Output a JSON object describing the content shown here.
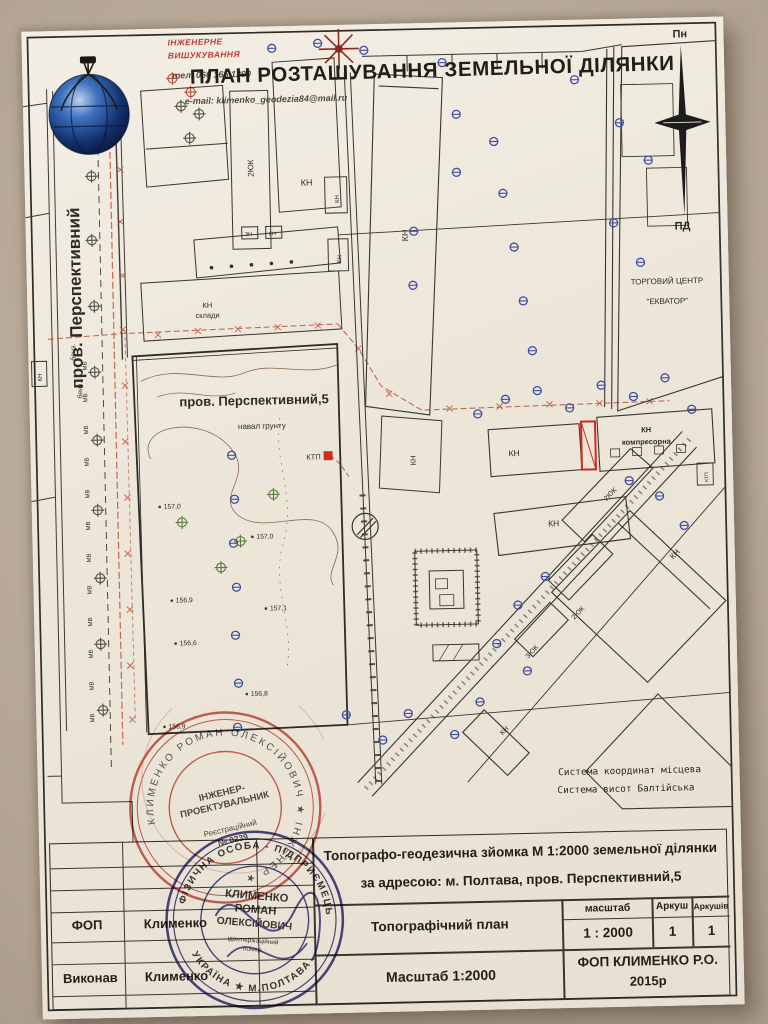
{
  "header": {
    "company_line1": "ІНЖЕНЕРНЕ",
    "company_line2": "ВИШУКУВАННЯ",
    "phone": "тел. 066 165 1200",
    "email": "e-mail: klimenko_geodezia84@mail.ru",
    "title": "ПЛАН РОЗТАШУВАННЯ ЗЕМЕЛЬНОЇ ДІЛЯНКИ"
  },
  "compass": {
    "north": "Пн",
    "south": "ПД"
  },
  "map": {
    "street_name": "пров. Перспективний",
    "parcel_label": "пров. Перспективний,5",
    "soil_note": "навал грунту",
    "ktp": "КТП",
    "kn": "КН",
    "kn_sklady_line1": "КН",
    "kn_sklady_line2": "склади",
    "kompresorna_line1": "КН",
    "kompresorna_line2": "компресорна",
    "label_2yuk": "2ЮК",
    "label_3yuk": "ЗЮК",
    "label_zn": "ЗН",
    "mall_line1": "ТОРГОВИЙ ЦЕНТР",
    "mall_line2": "\"ЕКВАТОР\"",
    "mv": "МВ",
    "benz": "бенз.",
    "elevations": [
      "157,0",
      "157,0",
      "156,9",
      "157,1",
      "156,6",
      "156,8",
      "156,9"
    ],
    "coord_line1": "Система координат місцева",
    "coord_line2": "Система висот Балтійська"
  },
  "title_block": {
    "survey_line1": "Топографо-геодезична зйомка М 1:2000 земельної ділянки",
    "survey_line2": "за адресою: м. Полтава, пров. Перспективний,5",
    "doc_title": "Топографічний план",
    "col_scale": "масштаб",
    "col_sheet": "Аркуш",
    "col_sheets": "Аркушів",
    "scale_value": "1 : 2000",
    "sheet_value": "1",
    "sheets_value": "1",
    "scale_note": "Масштаб 1:2000",
    "firm": "ФОП КЛИМЕНКО Р.О.",
    "year": "2015р",
    "fop_label": "ФОП",
    "fop_name": "Клименко",
    "exec_label": "Виконав",
    "exec_name": "Клименко"
  },
  "stamps": {
    "red": {
      "center_line1": "ІНЖЕНЕР-",
      "center_line2": "ПРОЕКТУВАЛЬНИК",
      "center_line3": "Реєстраційний",
      "center_line4": "№ 0239",
      "ring_text": "КЛИМЕНКО РОМАН ОЛЕКСІЙОВИЧ ★ ІНЖЕНЕР ★"
    },
    "blue": {
      "ring_top": "ФІЗИЧНА ОСОБА - ПІДПРИЄМЕЦЬ",
      "ring_bottom": "УКРАЇНА ★ М.ПОЛТАВА",
      "center_line1": "КЛИМЕНКО",
      "center_line2": "РОМАН",
      "center_line3": "ОЛЕКСІЙОВИЧ",
      "center_line4": "ідентифікаційний",
      "center_line5": "номер"
    }
  },
  "colors": {
    "paper": "#efe9dd",
    "backdrop": "#b3a493",
    "ink": "#2f2a24",
    "red_stamp": "#c23b2e",
    "blue_stamp": "#38387f",
    "utility_red": "#c0503c",
    "manhole_blue": "#3f4fa5"
  }
}
